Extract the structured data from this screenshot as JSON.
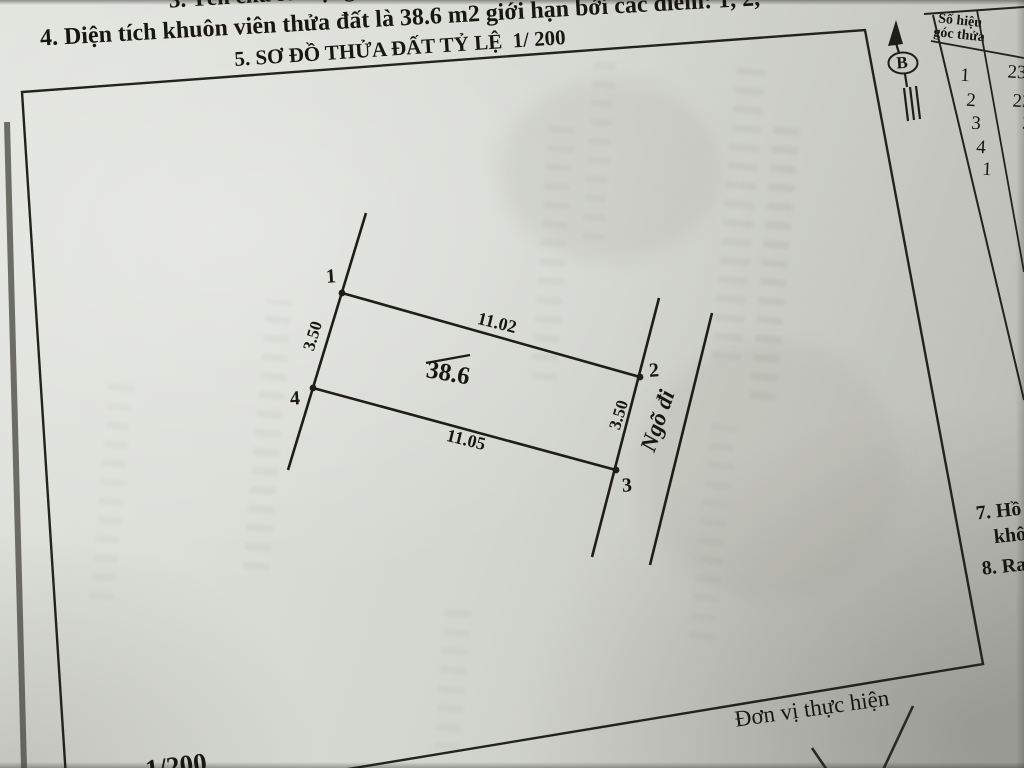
{
  "photo": {
    "paper_color": "#d6d8d2",
    "ink_color": "#1c1c15"
  },
  "header": {
    "line3_fragment": "3. Tên chủ sử dụng",
    "line4": "4. Diện tích khuôn viên thửa đất là 38.6 m2 giới hạn bởi các điểm: 1, 2,",
    "section5_title": "5. SƠ ĐỒ THỬA ĐẤT TỶ LỆ  1/ 200"
  },
  "north_arrow": {
    "label": "B"
  },
  "corner_table": {
    "header_line1": "Số hiệu",
    "header_line2": "góc thửa",
    "corner_numbers": [
      "1",
      "2",
      "3",
      "4",
      "1"
    ],
    "coordinate_fragments": [
      "23",
      "23",
      "2",
      "",
      ""
    ]
  },
  "plot": {
    "area_label": "38.6",
    "edge_top": "11.02",
    "edge_bottom": "11.05",
    "edge_left": "3.50",
    "edge_right": "3.50",
    "vertex_labels": [
      "1",
      "2",
      "3",
      "4"
    ],
    "alley_label": "Ngõ đi"
  },
  "side_notes": {
    "item7_line1": "7. Hồ s",
    "item7_line2": "khô",
    "item8": "8. Ra"
  },
  "footer": {
    "caption": "Đơn vị thực hiện",
    "scale_fragment": "1/200"
  }
}
